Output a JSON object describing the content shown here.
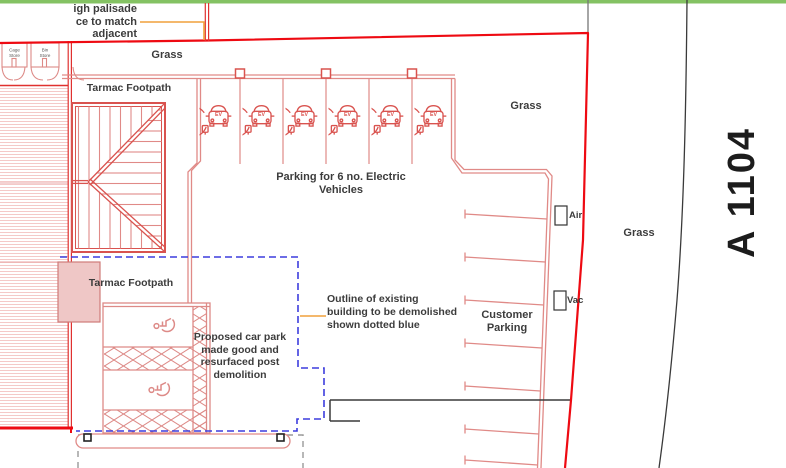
{
  "colors": {
    "boundary_red": "#ee0a12",
    "plan_pink": "#e08a87",
    "roof_red": "#d9534f",
    "demolition_outline_blue": "#3d3ddd",
    "grass_edge_green": "#84c263",
    "leader_orange": "#f0a13c",
    "kerb_black": "#3a3a3a"
  },
  "annotations": {
    "fence_note": {
      "line1": "igh palisade",
      "line2": "ce to match",
      "line3": "adjacent"
    },
    "demolition_note": {
      "line1": "Outline of existing",
      "line2": "building to be demolished",
      "line3": "shown dotted blue"
    },
    "proposed_note": {
      "line1": "Proposed car park",
      "line2": "made good and",
      "line3": "resurfaced post",
      "line4": "demolition"
    }
  },
  "labels": {
    "grass_top": "Grass",
    "grass_mid": "Grass",
    "grass_verge": "Grass",
    "tarmac_footpath_top": "Tarmac Footpath",
    "tarmac_footpath_lower": "Tarmac Footpath",
    "customer_parking_line1": "Customer",
    "customer_parking_line2": "Parking",
    "air": "Air",
    "vac": "Vac",
    "cage_store_line1": "Cage",
    "cage_store_line2": "Store",
    "bin_store_line1": "Bin",
    "bin_store_line2": "Store"
  },
  "ev_parking": {
    "note_line1": "Parking for 6 no. Electric",
    "note_line2": "Vehicles",
    "icon_label": "EV",
    "bay_count": 6
  },
  "road": {
    "name": "A 1104"
  }
}
